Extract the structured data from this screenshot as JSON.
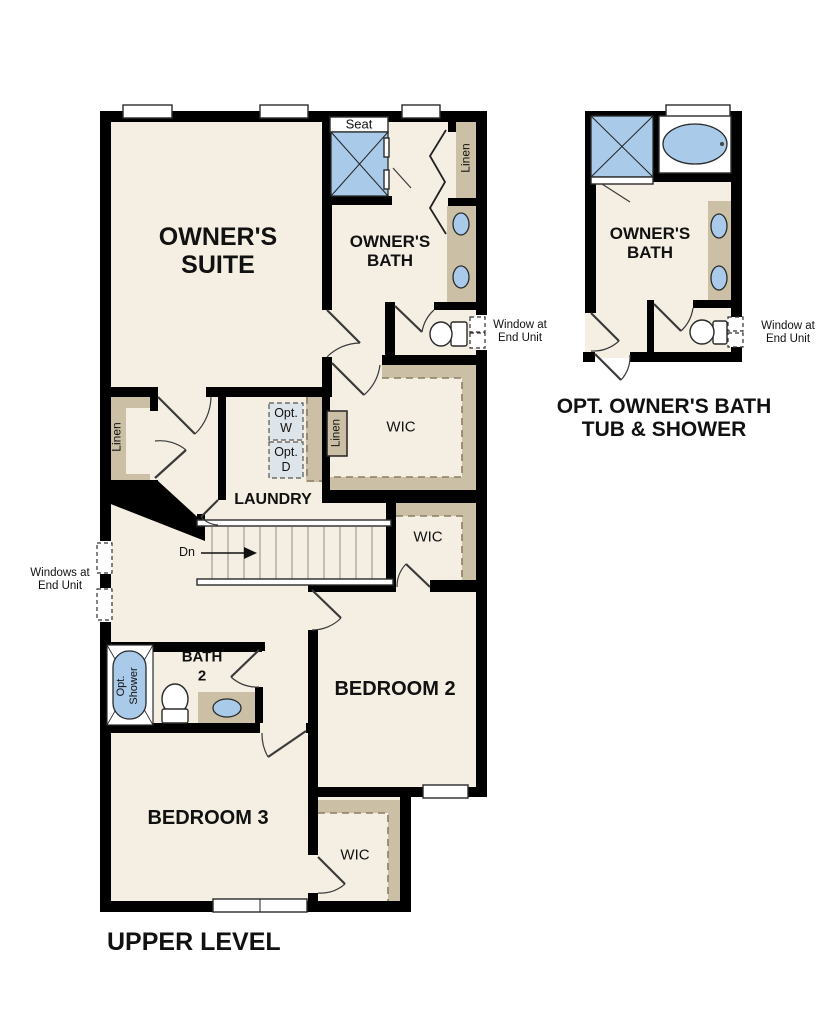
{
  "plan_title": "UPPER LEVEL",
  "colors": {
    "floor": "#f5efe3",
    "shelf": "#cbc0a5",
    "blue": "#a9cae9",
    "optwd": "#dde4ea",
    "wall": "#000000"
  },
  "labels": {
    "owners_suite_1": "OWNER'S",
    "owners_suite_2": "SUITE",
    "owners_bath_1": "OWNER'S",
    "owners_bath_2": "BATH",
    "seat": "Seat",
    "linen": "Linen",
    "wic": "WIC",
    "laundry": "LAUNDRY",
    "opt_w_1": "Opt.",
    "opt_w_2": "W",
    "opt_d_1": "Opt.",
    "opt_d_2": "D",
    "dn": "Dn",
    "window_right_1": "Window at",
    "window_right_2": "End Unit",
    "windows_left_1": "Windows at",
    "windows_left_2": "End Unit",
    "bath2_1": "BATH",
    "bath2_2": "2",
    "opt_shower_1": "Opt.",
    "opt_shower_2": "Shower",
    "bedroom2": "BEDROOM 2",
    "bedroom3": "BEDROOM 3",
    "opt_bath_title_1": "OPT. OWNER'S BATH",
    "opt_bath_title_2": "TUB & SHOWER"
  }
}
